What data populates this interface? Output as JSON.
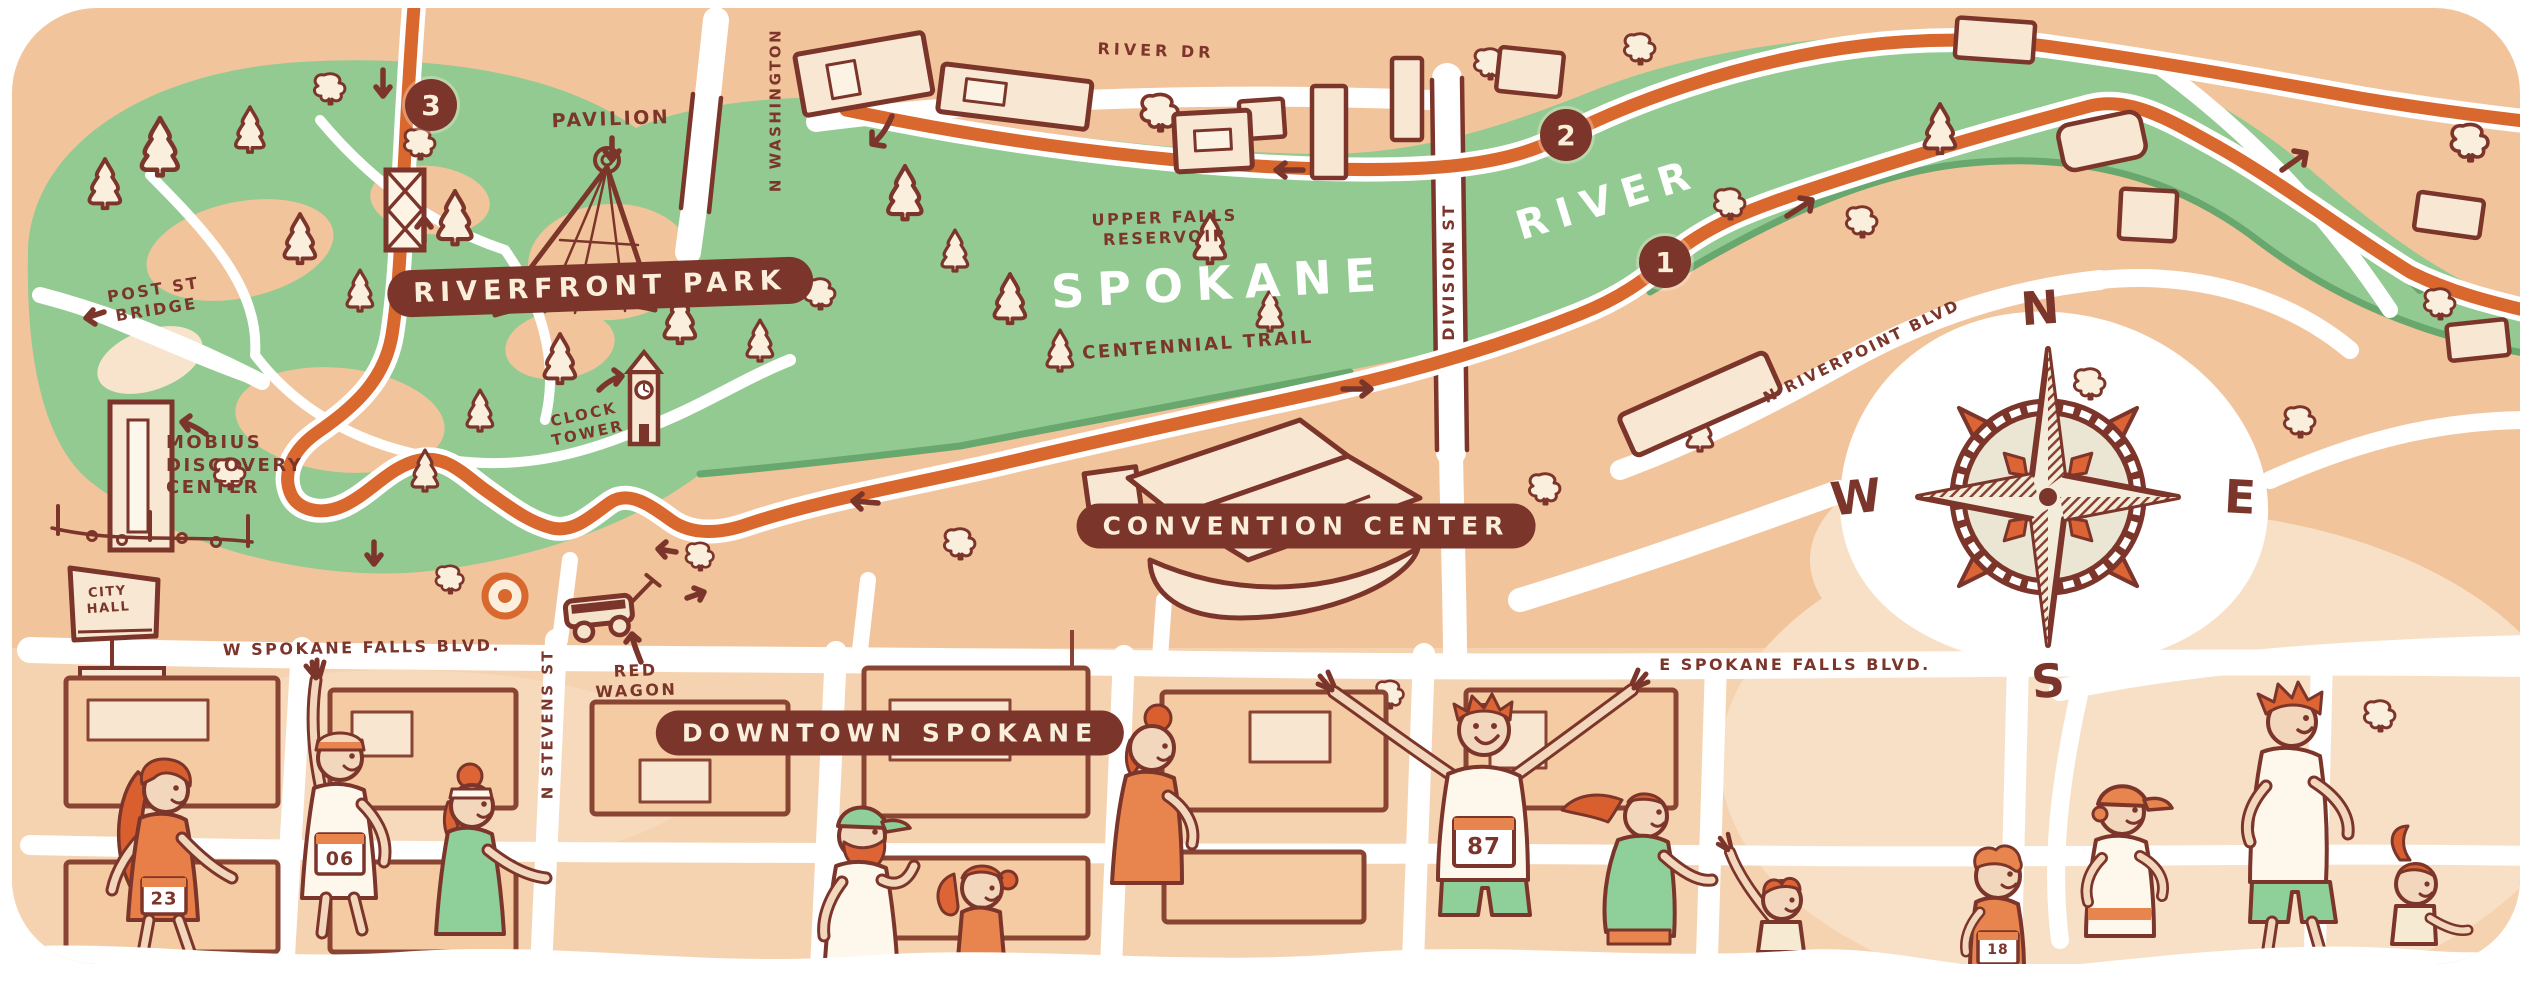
{
  "map": {
    "region_banners": {
      "riverfront_park": "RIVERFRONT PARK",
      "convention_center": "CONVENTION CENTER",
      "downtown_spokane": "DOWNTOWN SPOKANE"
    },
    "river_labels": {
      "spokane": "SPOKANE",
      "river": "RIVER"
    },
    "points_of_interest": {
      "pavilion": "PAVILION",
      "upper_falls_line1": "UPPER FALLS",
      "upper_falls_line2": "RESERVOIR",
      "centennial_trail": "CENTENNIAL TRAIL",
      "post_st_bridge_line1": "POST ST",
      "post_st_bridge_line2": "BRIDGE",
      "mobius_line1": "MOBIUS",
      "mobius_line2": "DISCOVERY",
      "mobius_line3": "CENTER",
      "city_hall_line1": "CITY",
      "city_hall_line2": "HALL",
      "clock_tower_line1": "CLOCK",
      "clock_tower_line2": "TOWER",
      "red_wagon_line1": "RED",
      "red_wagon_line2": "WAGON"
    },
    "streets": {
      "river_dr": "RIVER DR",
      "n_washington": "N WASHINGTON",
      "division_st": "DIVISION ST",
      "n_stevens_st": "N STEVENS ST",
      "w_spokane_falls_blvd": "W SPOKANE FALLS BLVD.",
      "e_spokane_falls_blvd": "E SPOKANE FALLS BLVD.",
      "n_riverpoint_blvd": "N RIVERPOINT BLVD"
    },
    "route_markers": {
      "m1": "1",
      "m2": "2",
      "m3": "3"
    },
    "compass": {
      "north": "N",
      "east": "E",
      "south": "S",
      "west": "W"
    },
    "runner_bibs": {
      "b23": "23",
      "b06": "06",
      "b87": "87",
      "b18": "18"
    },
    "colors": {
      "land_peach": "#f2c49b",
      "land_light": "#f8e0c6",
      "park_green": "#92ca92",
      "green_shadow": "#68a76d",
      "route_orange": "#d8682e",
      "outline_brown": "#7c352a",
      "cream": "#faeedd",
      "white": "#ffffff"
    }
  }
}
